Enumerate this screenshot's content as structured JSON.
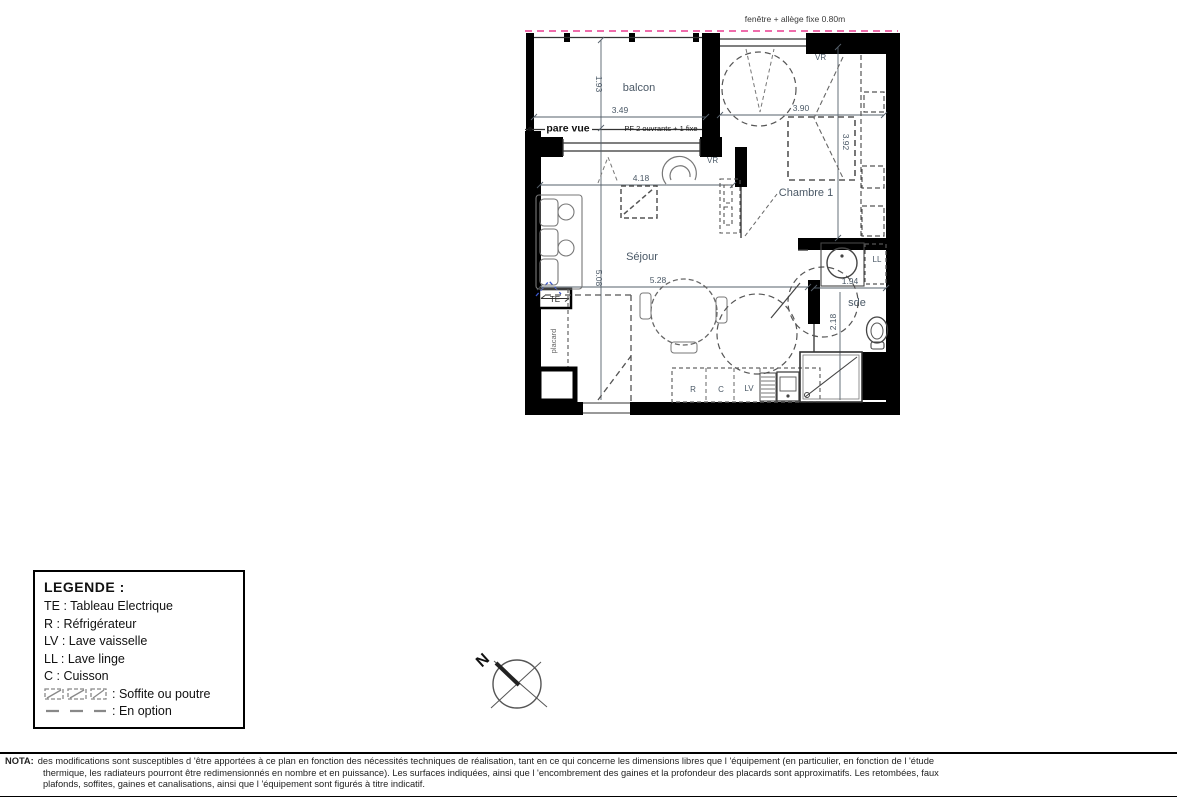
{
  "plan": {
    "rooms": {
      "balcon": "balcon",
      "sejour": "Séjour",
      "chambre": "Chambre 1",
      "sde": "sde"
    },
    "labels": {
      "pare_vue": "pare vue",
      "pf_window": "PF 2 ouvrants + 1 fixe",
      "fenetre": "fenêtre + allège fixe 0.80m",
      "vr": "VR",
      "te": "TE",
      "ll": "LL",
      "r": "R",
      "c": "C",
      "lv": "LV",
      "placard": "placard"
    },
    "dims": {
      "balcon_depth": "1.93",
      "balcon_width": "3.49",
      "sejour_top": "4.18",
      "sejour_depth": "5.08",
      "sejour_width": "5.28",
      "chambre_width": "3.90",
      "chambre_depth": "3.92",
      "sde_width": "1.94",
      "sde_depth": "2.18"
    }
  },
  "legend": {
    "title": "LEGENDE :",
    "items": [
      "TE : Tableau Electrique",
      "R : Réfrigérateur",
      "LV : Lave vaisselle",
      "LL : Lave linge",
      "C : Cuisson"
    ],
    "soffite": ": Soffite ou poutre",
    "option": ": En option"
  },
  "compass": {
    "north": "N"
  },
  "nota": {
    "label": "NOTA:",
    "lines": [
      "des modifications sont susceptibles d 'être apportées à ce plan en fonction des nécessités techniques de réalisation, tant en ce qui concerne les dimensions libres que l 'équipement (en particulier, en fonction de l 'étude",
      "thermique, les radiateurs pourront être redimensionnés en nombre et en puissance). Les surfaces indiquées, ainsi que l 'encombrement des gaines et la profondeur des placards sont approximatifs. Les retombées, faux",
      "plafonds, soffites, gaines et canalisations, ainsi que l 'équipement sont figurés à titre indicatif."
    ]
  },
  "colors": {
    "wall": "#000000",
    "dim_text": "#4a5866",
    "accent_magenta": "#ef6cab",
    "option_blue": "#3b57cc",
    "furniture": "#777777"
  }
}
